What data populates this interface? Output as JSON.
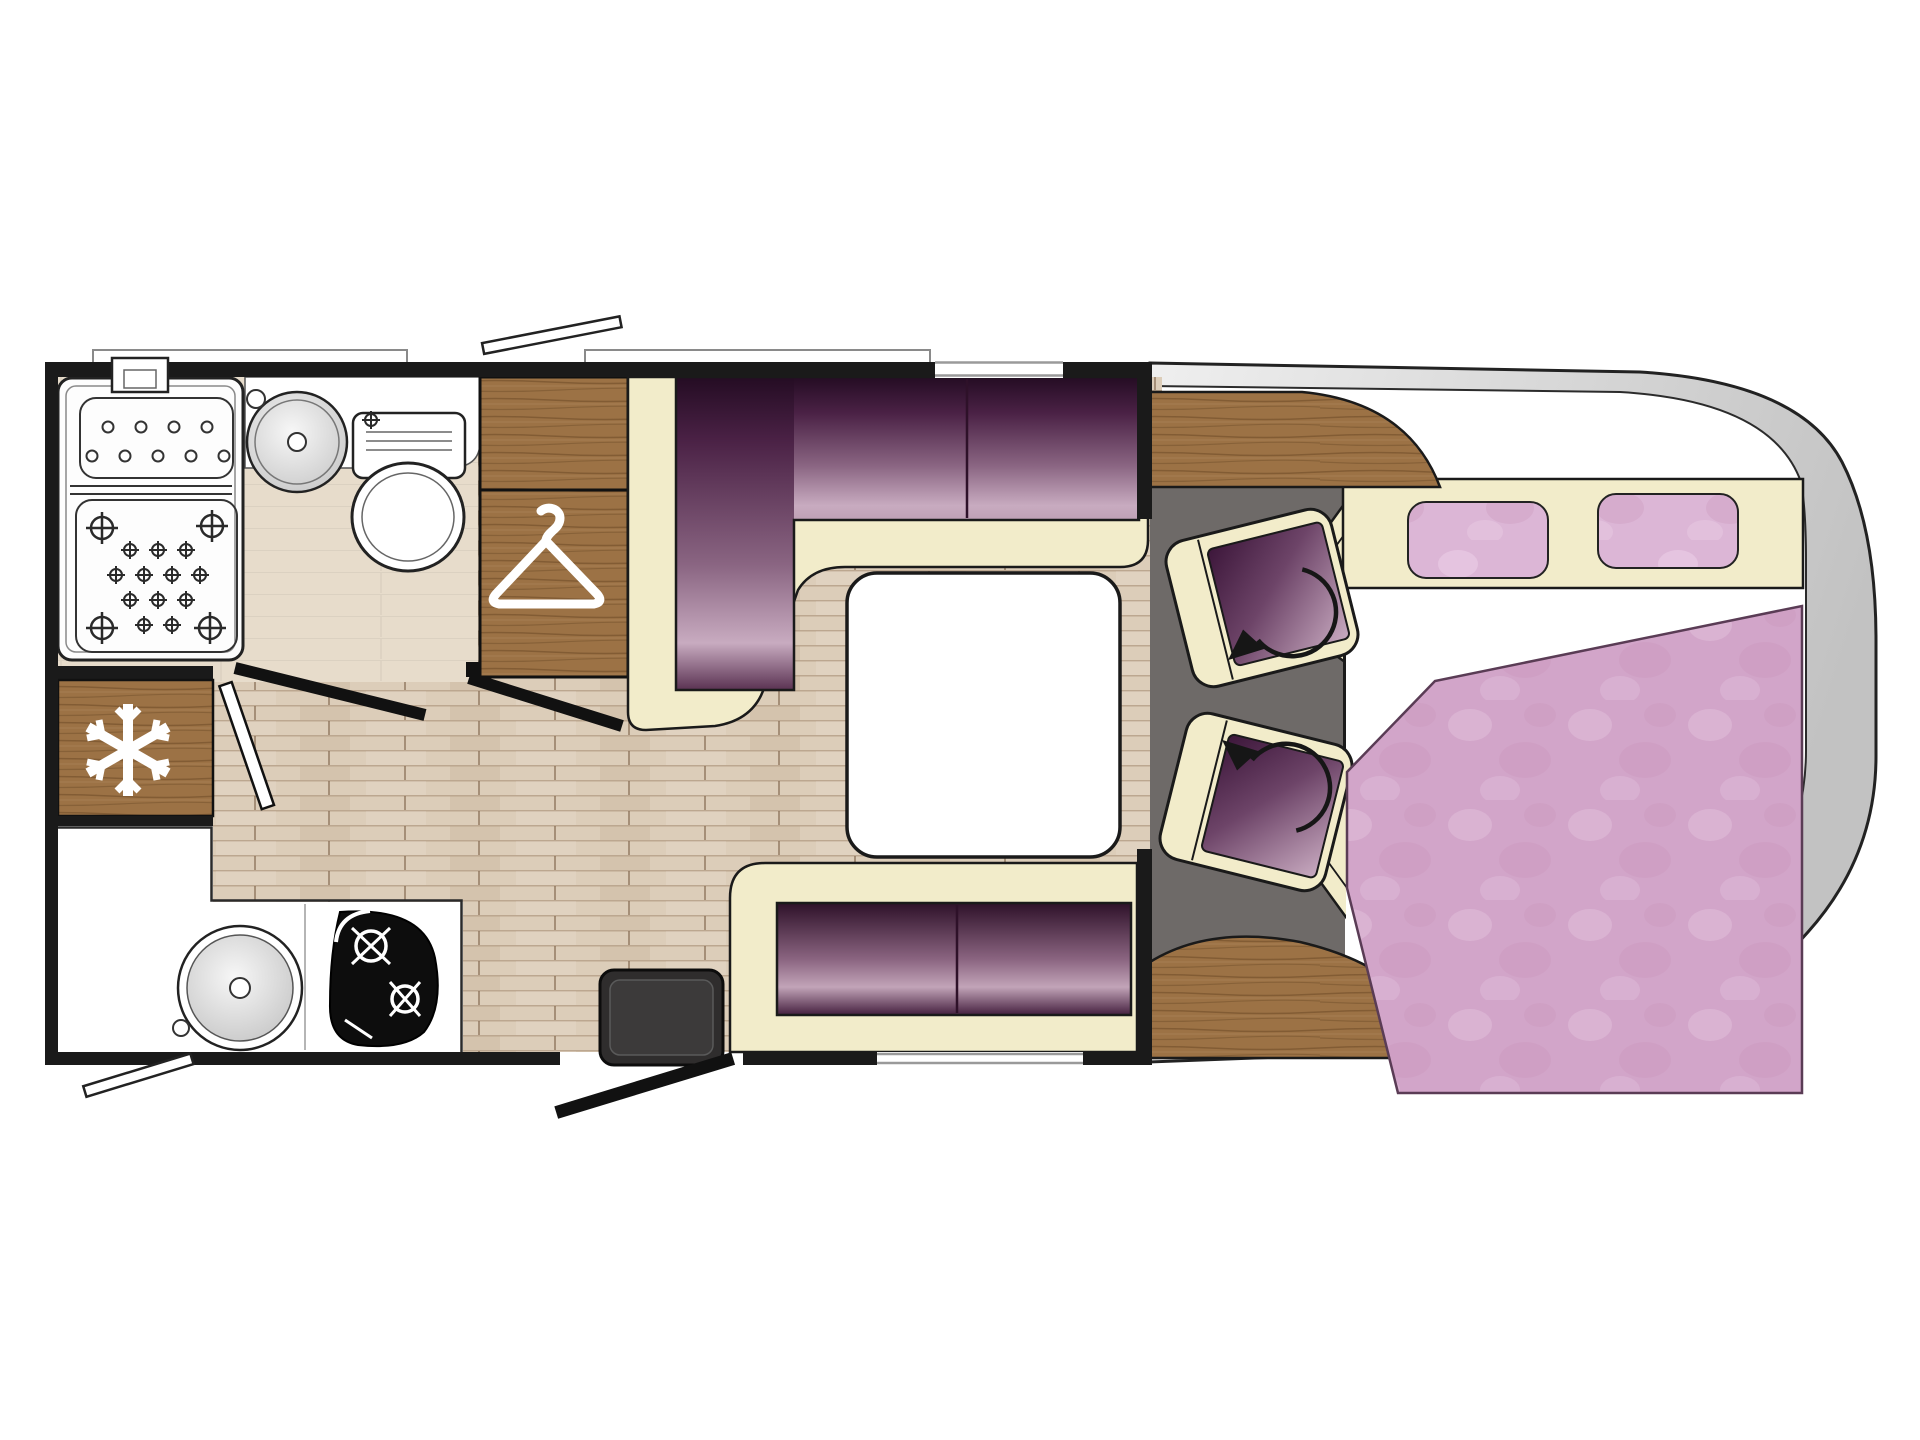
{
  "palette": {
    "ink": "#1a1a1a",
    "white": "#ffffff",
    "cream": "#f2ecca",
    "wood": "#9c7245",
    "floor": "#dccdb9",
    "bathFloor": "#e7dccb",
    "cabFloor": "#6e6a68",
    "bodyGray": "#d6d6d6",
    "pink": "#d2a5c9",
    "pinkLight": "#dcb6d6",
    "purpleDark": "#240c23",
    "purpleMid": "#8a6582",
    "purpleLight": "#c8abc0",
    "windowLine": "#9a9a9a"
  },
  "icons": [
    {
      "name": "snowflake-icon",
      "meaning": "refrigerator"
    },
    {
      "name": "hanger-icon",
      "meaning": "wardrobe"
    },
    {
      "name": "rotation-arrow-icon",
      "meaning": "swivel cab seat"
    }
  ],
  "fixtures": [
    "shower-tray",
    "washbasin",
    "toilet",
    "bathroom-door",
    "wardrobe",
    "refrigerator",
    "kitchen-counter",
    "kitchen-sink",
    "gas-hob",
    "dinette-front-sofa",
    "dinette-rear-sofa",
    "dinette-table",
    "swivel-seat-driver",
    "swivel-seat-passenger",
    "double-bed",
    "pillow",
    "duvet",
    "entry-step",
    "entry-door",
    "vehicle-front-outline",
    "dashboard-wood",
    "roof-vent",
    "window"
  ]
}
